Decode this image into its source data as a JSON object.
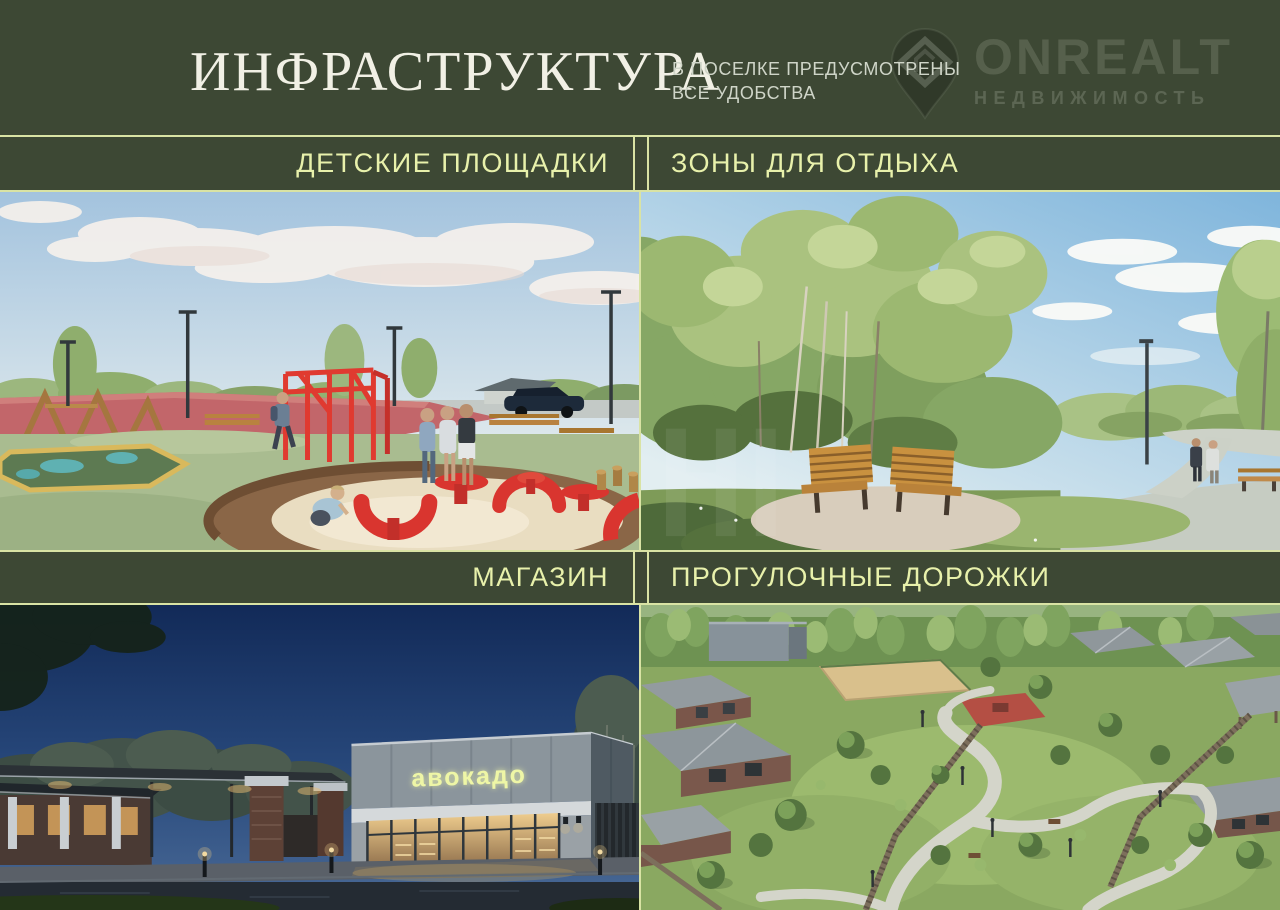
{
  "header": {
    "title": "ИНФРАСТРУКТУРА",
    "subtitle_line1": "В ПОСЕЛКЕ ПРЕДУСМОТРЕНЫ",
    "subtitle_line2": "ВСЕ УДОБСТВА"
  },
  "logo": {
    "brand": "ONREALT",
    "tagline": "НЕДВИЖИМОСТЬ",
    "icon": "location-pin-with-diamond"
  },
  "sections": [
    {
      "label": "ДЕТСКИЕ ПЛОЩАДКИ",
      "description": "Render of a playground: red climbing frame, red play sculptures in a round sand pit with wooden deck, children and adults, pink track, sage rubber surface, lamp posts, summer sky with clouds"
    },
    {
      "label": "ЗОНЫ ДЛЯ ОТДЫХА",
      "description": "Render of a park recreation area: two wooden benches back to back on a gravel pad among birch trees, flower meadow, walking path with a strolling couple"
    },
    {
      "label": "МАГАЗИН",
      "description": "Evening render of a modern store with a glowing storefront and sign, brick entrance gate with white columns, bollard lights, dark blue sky"
    },
    {
      "label": "ПРОГУЛОЧНЫЕ ДОРОЖКИ",
      "description": "Aerial render of winding walking paths over lawns between cottages, wooden fences, sport courts and forest"
    }
  ],
  "shop_sign": "авокадо",
  "colors": {
    "panel_green": "#3d4834",
    "divider_line": "#d9e3a4",
    "label_lime": "#e8f1ab",
    "title_cream": "#f1f0e5",
    "subtitle_gray": "#cfd5c8"
  }
}
